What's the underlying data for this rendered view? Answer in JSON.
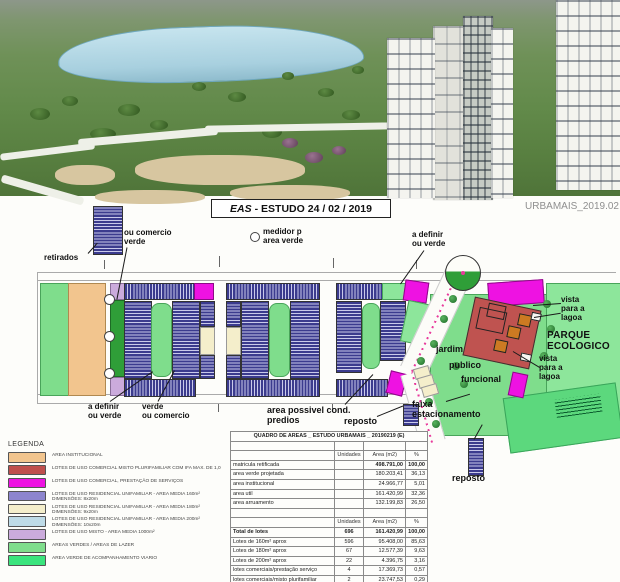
{
  "header": {
    "title_eas": "EAS",
    "title_rest": "- ESTUDO 24 / 02 / 2019",
    "watermark": "URBAMAIS_2019.02"
  },
  "plan": {
    "labels": {
      "retirados": "retirados",
      "ou_comercio_verde": "ou comercio\nverde",
      "medidor": "medidor p\narea verde",
      "a_definir_top": "a definir\nou verde",
      "a_definir_bottom": "a definir\nou verde",
      "verde_ou_comercio": "verde\nou comercio",
      "area_possivel": "area possivel  cond.\npredios",
      "reposto_mid": "reposto",
      "faixa_estacionamento": "faixa\nestacionamento",
      "reposto_right": "reposto",
      "jardim": "jardim",
      "publico": "publico",
      "funcional": "funcional",
      "vista_lagoa_1": "vista\npara a\nlagoa",
      "parque_ecologico": "PARQUE\nECOLOGICO",
      "vista_lagoa_2": "vista\npara a\nlagoa"
    },
    "accent_colors": {
      "avenue_centerline": "#e83a9c",
      "lot_hatch": "#3b3b8e"
    }
  },
  "legend": {
    "title": "LEGENDA",
    "items": [
      {
        "color": "#f2c58e",
        "label": "AREA INSTITUCIONAL"
      },
      {
        "color": "#bf4f4d",
        "label": "LOTES DE USO COMERCIAL MISTO PLURIFAMILIAR COM IFA MAX. DE 1,0"
      },
      {
        "color": "#ee12e2",
        "label": "LOTES DE USO COMERCIAL, PRESTAÇÃO DE SERVIÇOS"
      },
      {
        "color": "#8d85ce",
        "label": "LOTES DE USO RESIDENCIAL UNIFAMILIAR - AREA MEDIA 160m²\nDIMENSÕES: 8x20m"
      },
      {
        "color": "#f4eecb",
        "label": "LOTES DE USO RESIDENCIAL UNIFAMILIAR - AREA MEDIA 180m²\nDIMENSÕES: 9x20m"
      },
      {
        "color": "#bedbe7",
        "label": "LOTES DE USO RESIDENCIAL UNIFAMILIAR - AREA MEDIA 200m²\nDIMENSÕES: 10x20m"
      },
      {
        "color": "#cbabdc",
        "label": "LOTES DE USO MISTO - AREA MEDIA 1000m²"
      },
      {
        "color": "#7fdd8c",
        "label": "AREAS VERDES / AREAS DE LAZER"
      },
      {
        "color": "#3ae47d",
        "label": "AREA VERDE DE ACOMPANHAMENTO VIARIO"
      }
    ]
  },
  "table": {
    "title": "QUADRO DE AREAS _ ESTUDO URBAMAIS _ 20190219 (E)",
    "columns": [
      "",
      "Unidades",
      "Area (m2)",
      "%"
    ],
    "section1": [
      {
        "label": "matricula retificada",
        "unidades": "",
        "area": "498.791,00",
        "pct": "100,00",
        "cls": "num-bold"
      },
      {
        "label": "area verde projetada",
        "unidades": "",
        "area": "180.203,41",
        "pct": "36,13",
        "cls": ""
      },
      {
        "label": "area institucional",
        "unidades": "",
        "area": "24.966,77",
        "pct": "5,01",
        "cls": ""
      },
      {
        "label": "area util",
        "unidades": "",
        "area": "161.420,99",
        "pct": "32,36",
        "cls": ""
      },
      {
        "label": "area arruamento",
        "unidades": "",
        "area": "132.199,83",
        "pct": "26,50",
        "cls": ""
      }
    ],
    "section2": [
      {
        "label": "Total de lotes",
        "unidades": "696",
        "area": "161.420,99",
        "pct": "100,00",
        "cls": "bold"
      },
      {
        "label": "Lotes de 160m² aprox",
        "unidades": "596",
        "area": "95.408,00",
        "pct": "85,63",
        "cls": ""
      },
      {
        "label": "Lotes de 180m² aprox",
        "unidades": "67",
        "area": "12.577,39",
        "pct": "9,63",
        "cls": ""
      },
      {
        "label": "Lotes de 200m² aprox",
        "unidades": "22",
        "area": "4.396,75",
        "pct": "3,16",
        "cls": ""
      },
      {
        "label": "lotes comerciais/prestação serviço",
        "unidades": "4",
        "area": "17.369,73",
        "pct": "0,57",
        "cls": ""
      },
      {
        "label": "lotes comerciais/misto plurifamiliar",
        "unidades": "2",
        "area": "23.747,53",
        "pct": "0,29",
        "cls": ""
      },
      {
        "label": "lotes residencial unifamiliar (1000m2)",
        "unidades": "5",
        "area": "7.921,59",
        "pct": "0,72",
        "cls": ""
      }
    ]
  }
}
